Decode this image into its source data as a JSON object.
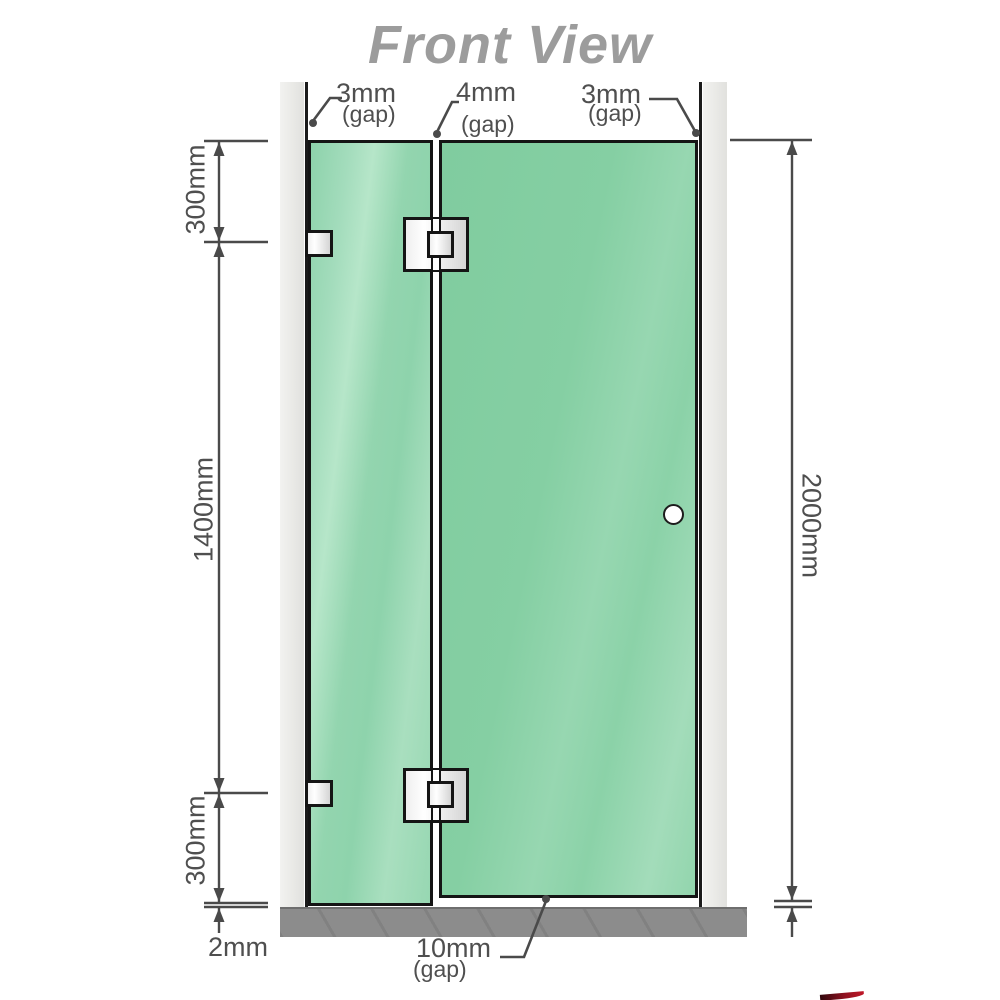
{
  "title": "Front View",
  "gap_labels": {
    "left": {
      "value": "3mm",
      "note": "(gap)"
    },
    "center": {
      "value": "4mm",
      "note": "(gap)"
    },
    "right": {
      "value": "3mm",
      "note": "(gap)"
    },
    "door_bottom": {
      "value": "10mm",
      "note": "(gap)"
    }
  },
  "measurements": {
    "top_segment": "300mm",
    "middle_segment": "1400mm",
    "bottom_segment": "300mm",
    "overall_height": "2000mm",
    "floor_gap": "2mm"
  },
  "colors": {
    "glass_green": "#8fd2ab",
    "glass_green_light": "#b6e6c9",
    "wall_gray": "#e9e9e6",
    "floor_gray": "#8c8c8c",
    "outline_black": "#151515",
    "dimension_gray": "#4f4f4f",
    "title_gray": "#9c9c9c",
    "hardware_white": "#ffffff"
  }
}
